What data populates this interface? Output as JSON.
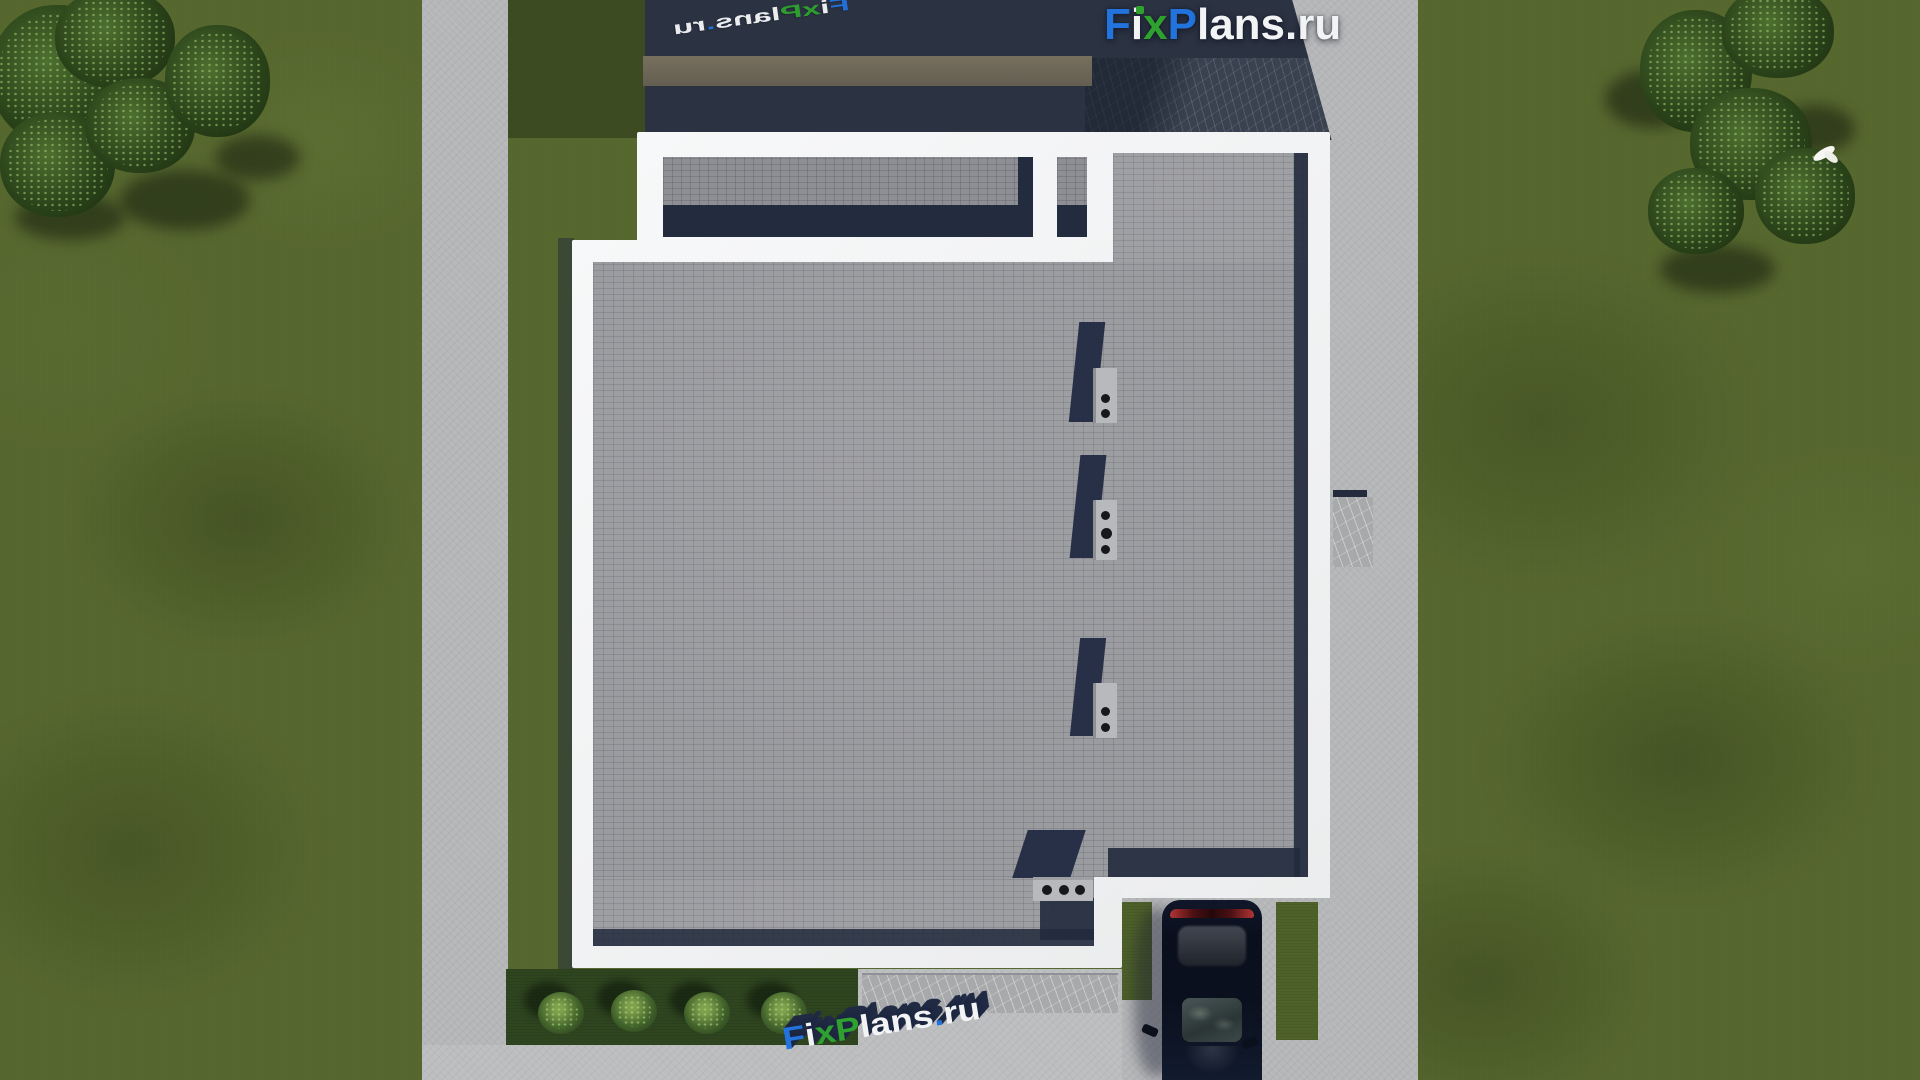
{
  "brand": {
    "name": "FixPlans.ru",
    "letters": {
      "f": "F",
      "i": "i",
      "x": "x",
      "p": "P",
      "lans": "lans",
      "dot": ".",
      "ru": "ru"
    },
    "colors": {
      "blue": "#2273dc",
      "green": "#2fa12f",
      "white": "#f2f3f5"
    }
  },
  "watermarks": {
    "top_right_logo": "FixPlans.ru",
    "top_left_ground": "FixPlans.ru",
    "bottom_ground": "FixPlans.ru"
  },
  "scene": {
    "house": {
      "roof_material": "gray flat roof tiles with white parapet",
      "chimney_count": 3,
      "roof_vent_pipe_count": 3
    },
    "car": {
      "color": "black"
    },
    "bush_count": 4,
    "bird_color": "white",
    "palette": {
      "lawn": "#57682f",
      "concrete": "#b5b6b8",
      "roof": "#9a9b9f",
      "parapet": "#f2f3f4",
      "shadow": "#232b3e",
      "wall_top": "#6d675b"
    }
  }
}
